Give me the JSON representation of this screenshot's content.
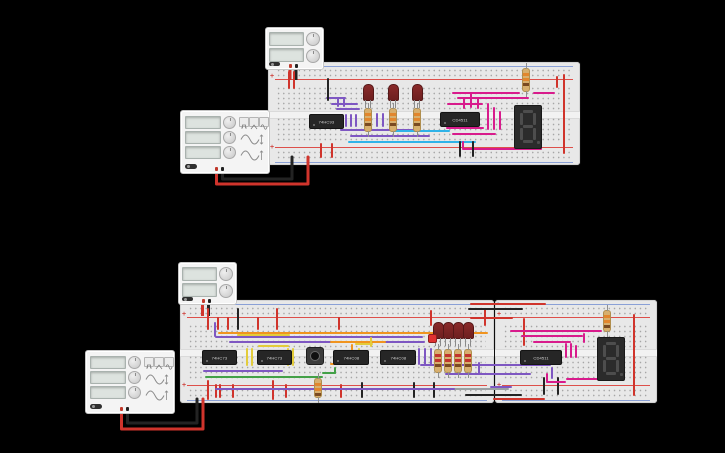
{
  "canvas": {
    "background": "#000000",
    "width": 725,
    "height": 453,
    "app": "circuit-simulator-canvas"
  },
  "rails": {
    "plus": "+",
    "minus": "-"
  },
  "palette": {
    "red": "#d0342c",
    "black": "#232323",
    "purple": "#7e57c2",
    "blue": "#2fb3e8",
    "magenta": "#d81b8c",
    "orange": "#f0941f",
    "yellow": "#e3cc3b",
    "green": "#43a047",
    "gray": "#9aa0a3"
  },
  "circuits": {
    "top": {
      "power_supply": {
        "type": "power-supply",
        "screens": 2,
        "knobs": 2
      },
      "function_generator": {
        "type": "function-generator",
        "screens": 3,
        "knobs": 3,
        "wave_buttons": 3
      },
      "breadboard_count": 1,
      "ics": [
        {
          "label": "74HC93"
        },
        {
          "label": "CD4511"
        }
      ],
      "led_count": 3,
      "resistor_count": 4,
      "seven_segment": {
        "value": "8.",
        "state": "off"
      }
    },
    "bottom": {
      "power_supply": {
        "type": "power-supply",
        "screens": 2,
        "knobs": 2
      },
      "function_generator": {
        "type": "function-generator",
        "screens": 3,
        "knobs": 3,
        "wave_buttons": 3
      },
      "breadboard_count": 2,
      "ics": [
        {
          "label": "74HC73"
        },
        {
          "label": "74HC73"
        },
        {
          "label": "74HC08"
        },
        {
          "label": "74HC08"
        },
        {
          "label": "CD4511"
        }
      ],
      "pushbutton_count": 1,
      "led_count": 5,
      "resistor_count": 6,
      "seven_segment": {
        "value": "8.",
        "state": "off"
      }
    }
  },
  "wires": [
    [
      326,
      97,
      20,
      2,
      "purple"
    ],
    [
      331,
      103,
      27,
      2,
      "purple"
    ],
    [
      336,
      108,
      24,
      2,
      "purple"
    ],
    [
      337,
      97,
      2,
      10,
      "purple"
    ],
    [
      343,
      97,
      2,
      10,
      "purple"
    ],
    [
      345,
      114,
      2,
      13,
      "purple"
    ],
    [
      350,
      114,
      2,
      13,
      "purple"
    ],
    [
      355,
      114,
      2,
      13,
      "purple"
    ],
    [
      340,
      129,
      80,
      2,
      "purple"
    ],
    [
      350,
      135,
      80,
      2,
      "purple"
    ],
    [
      376,
      113,
      2,
      14,
      "purple"
    ],
    [
      382,
      113,
      2,
      14,
      "purple"
    ],
    [
      393,
      130,
      57,
      2,
      "blue"
    ],
    [
      348,
      141,
      128,
      2,
      "blue"
    ],
    [
      452,
      92,
      68,
      2,
      "magenta"
    ],
    [
      457,
      97,
      72,
      2,
      "magenta"
    ],
    [
      447,
      103,
      36,
      2,
      "magenta"
    ],
    [
      463,
      97,
      2,
      12,
      "magenta"
    ],
    [
      470,
      92,
      2,
      16,
      "magenta"
    ],
    [
      477,
      97,
      2,
      12,
      "magenta"
    ],
    [
      487,
      103,
      2,
      27,
      "magenta"
    ],
    [
      493,
      107,
      2,
      23,
      "magenta"
    ],
    [
      499,
      111,
      2,
      19,
      "magenta"
    ],
    [
      446,
      127,
      38,
      2,
      "magenta"
    ],
    [
      452,
      133,
      44,
      2,
      "magenta"
    ],
    [
      462,
      141,
      2,
      8,
      "magenta"
    ],
    [
      462,
      148,
      80,
      2,
      "magenta"
    ],
    [
      540,
      141,
      2,
      8,
      "magenta"
    ],
    [
      533,
      92,
      22,
      2,
      "magenta"
    ],
    [
      288,
      71,
      2,
      18,
      "red"
    ],
    [
      293,
      71,
      2,
      18,
      "red"
    ],
    [
      320,
      143,
      2,
      15,
      "red"
    ],
    [
      331,
      143,
      2,
      15,
      "red"
    ],
    [
      563,
      74,
      2,
      80,
      "red"
    ],
    [
      556,
      76,
      2,
      12,
      "red"
    ],
    [
      327,
      78,
      2,
      23,
      "black"
    ],
    [
      459,
      141,
      2,
      16,
      "black"
    ],
    [
      472,
      141,
      2,
      16,
      "black"
    ],
    [
      207,
      308,
      2,
      22,
      "red"
    ],
    [
      217,
      317,
      2,
      13,
      "red"
    ],
    [
      227,
      317,
      2,
      13,
      "red"
    ],
    [
      257,
      317,
      2,
      13,
      "red"
    ],
    [
      276,
      308,
      2,
      22,
      "red"
    ],
    [
      338,
      317,
      2,
      13,
      "red"
    ],
    [
      430,
      310,
      2,
      16,
      "red"
    ],
    [
      484,
      308,
      2,
      18,
      "red"
    ],
    [
      207,
      380,
      2,
      20,
      "red"
    ],
    [
      215,
      384,
      2,
      14,
      "red"
    ],
    [
      219,
      384,
      2,
      14,
      "red"
    ],
    [
      232,
      384,
      2,
      14,
      "red"
    ],
    [
      272,
      380,
      2,
      20,
      "red"
    ],
    [
      285,
      384,
      2,
      14,
      "red"
    ],
    [
      340,
      384,
      2,
      14,
      "red"
    ],
    [
      470,
      303,
      76,
      2,
      "red"
    ],
    [
      470,
      317,
      43,
      2,
      "red"
    ],
    [
      523,
      318,
      2,
      28,
      "red"
    ],
    [
      633,
      314,
      2,
      82,
      "red"
    ],
    [
      493,
      398,
      52,
      2,
      "red"
    ],
    [
      237,
      308,
      2,
      22,
      "black"
    ],
    [
      361,
      382,
      2,
      16,
      "black"
    ],
    [
      413,
      382,
      2,
      16,
      "black"
    ],
    [
      433,
      382,
      2,
      16,
      "black"
    ],
    [
      468,
      308,
      55,
      2,
      "black"
    ],
    [
      465,
      394,
      57,
      2,
      "black"
    ],
    [
      543,
      377,
      2,
      18,
      "black"
    ],
    [
      557,
      377,
      2,
      18,
      "black"
    ],
    [
      445,
      388,
      64,
      2,
      "gray"
    ],
    [
      214,
      322,
      2,
      15,
      "purple"
    ],
    [
      215,
      336,
      208,
      2,
      "purple"
    ],
    [
      229,
      341,
      196,
      2,
      "purple"
    ],
    [
      203,
      370,
      80,
      2,
      "purple"
    ],
    [
      418,
      348,
      2,
      17,
      "purple"
    ],
    [
      424,
      348,
      2,
      17,
      "purple"
    ],
    [
      430,
      348,
      2,
      17,
      "purple"
    ],
    [
      420,
      364,
      131,
      2,
      "purple"
    ],
    [
      445,
      373,
      86,
      2,
      "purple"
    ],
    [
      215,
      388,
      240,
      2,
      "purple"
    ],
    [
      490,
      386,
      22,
      2,
      "purple"
    ],
    [
      551,
      367,
      2,
      12,
      "purple"
    ],
    [
      478,
      362,
      2,
      12,
      "purple"
    ],
    [
      218,
      332,
      270,
      2,
      "orange"
    ],
    [
      330,
      341,
      56,
      2,
      "orange"
    ],
    [
      351,
      344,
      2,
      19,
      "orange"
    ],
    [
      330,
      363,
      30,
      2,
      "orange"
    ],
    [
      237,
      334,
      53,
      2,
      "yellow"
    ],
    [
      258,
      345,
      31,
      2,
      "yellow"
    ],
    [
      246,
      348,
      2,
      18,
      "yellow"
    ],
    [
      251,
      348,
      2,
      18,
      "yellow"
    ],
    [
      287,
      348,
      2,
      18,
      "yellow"
    ],
    [
      292,
      348,
      2,
      18,
      "yellow"
    ],
    [
      355,
      343,
      18,
      2,
      "yellow"
    ],
    [
      358,
      348,
      2,
      15,
      "yellow"
    ],
    [
      370,
      337,
      2,
      10,
      "yellow"
    ],
    [
      205,
      376,
      118,
      2,
      "green"
    ],
    [
      322,
      372,
      14,
      2,
      "green"
    ],
    [
      334,
      367,
      2,
      7,
      "green"
    ],
    [
      510,
      330,
      92,
      2,
      "magenta"
    ],
    [
      521,
      335,
      62,
      2,
      "magenta"
    ],
    [
      533,
      341,
      38,
      2,
      "magenta"
    ],
    [
      565,
      343,
      2,
      15,
      "magenta"
    ],
    [
      570,
      343,
      2,
      15,
      "magenta"
    ],
    [
      575,
      345,
      2,
      13,
      "magenta"
    ],
    [
      583,
      333,
      2,
      10,
      "magenta"
    ],
    [
      566,
      378,
      40,
      2,
      "magenta"
    ],
    [
      546,
      381,
      20,
      2,
      "magenta"
    ],
    [
      546,
      373,
      2,
      9,
      "magenta"
    ]
  ]
}
